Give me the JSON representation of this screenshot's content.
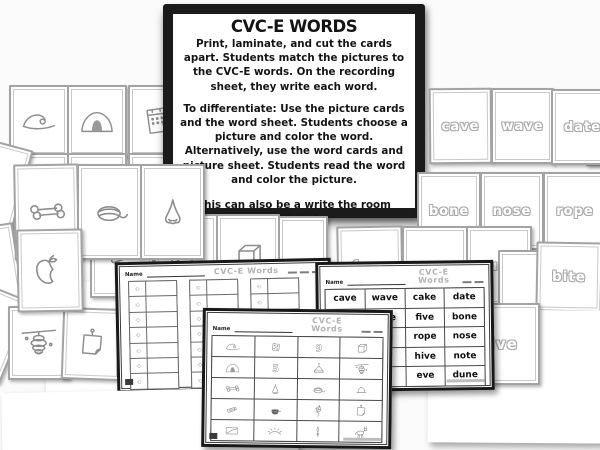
{
  "instruction_panel": {
    "title": "CVC-E WORDS",
    "paragraphs": [
      "Print, laminate, and cut the cards apart.  Students match the pictures to the CVC-E words.  On the recording sheet, they write each word.",
      "To differentiate:  Use the picture cards and the word sheet.  Students choose a picture and color the word. Alternatively, use the word cards and picture sheet.  Students read the word and color the picture.",
      "This can also be a write the room activity!"
    ]
  },
  "word_cards": [
    "cave",
    "wave",
    "date",
    "bone",
    "nose",
    "rope",
    "fuse",
    "eve",
    "cube",
    "bite",
    "hive"
  ],
  "picture_cards": [
    "wave",
    "cave",
    "date",
    "bone",
    "rope",
    "nose",
    "bite",
    "tube",
    "mule",
    "cube",
    "hive",
    "note"
  ],
  "word_sheet": {
    "title": "CVC-E Words",
    "name_label": "Name",
    "rows": [
      [
        "cave",
        "wave",
        "cake",
        "date"
      ],
      [
        "hose",
        "nine",
        "five",
        "bone"
      ],
      [
        "",
        "",
        "rope",
        "nose"
      ],
      [
        "",
        "",
        "hive",
        "note"
      ],
      [
        "",
        "",
        "eve",
        "dune"
      ]
    ]
  },
  "picture_sheet": {
    "title": "CVC-E Words",
    "name_label": "Name",
    "cells": [
      "wave",
      "dice",
      "nine",
      "cube",
      "cave",
      "five",
      "cake",
      "hive",
      "bone",
      "nose",
      "rope",
      "dome",
      "tube",
      "pot",
      "kite",
      "note",
      "line",
      "dune",
      "vine",
      "mule"
    ]
  },
  "recording_sheet": {
    "title": "CVC-E Words",
    "name_label": "Name",
    "rows": 7,
    "groups": 3
  }
}
